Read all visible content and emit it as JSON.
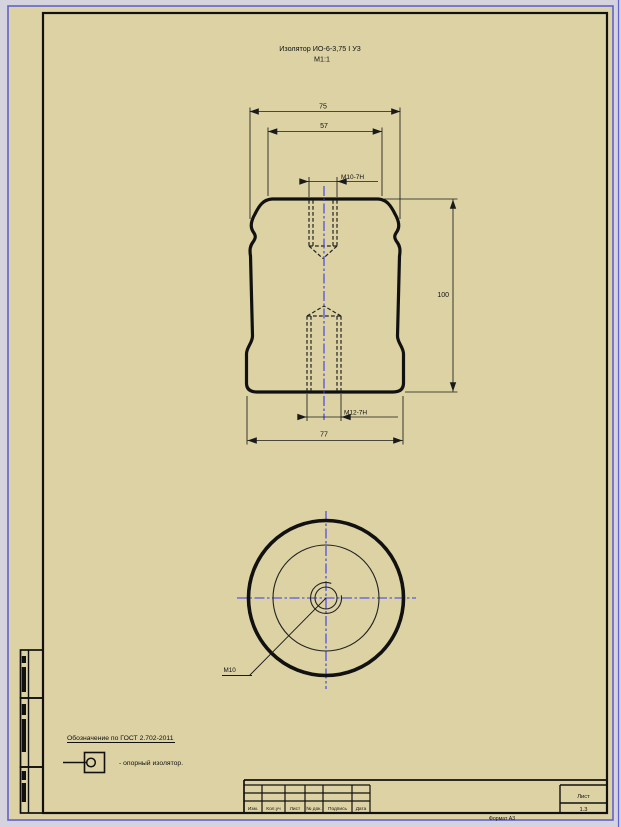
{
  "drawing": {
    "title": "Изолятор ИО-6-3,75 I У3",
    "scale": "М1:1",
    "front_view": {
      "dim_top_width": "75",
      "dim_face_width": "57",
      "dim_top_thread": "M10-7H",
      "dim_height": "100",
      "dim_bottom_thread": "M12-7H",
      "dim_bottom_width": "77"
    },
    "bottom_view": {
      "thread_callout": "M10"
    },
    "legend": {
      "heading": "Обозначение по ГОСТ 2.702-2011",
      "item_caption": "- опорный изолятор."
    },
    "title_block": {
      "columns": [
        "Изм.",
        "Кол.уч",
        "Лист",
        "№ док.",
        "Подпись",
        "Дата"
      ],
      "sheet_label": "Лист",
      "sheet_number": "1.3",
      "format_note": "Формат А3"
    },
    "colors": {
      "page_background": "#d5d3dd",
      "paper": "#dcd2a4",
      "paper_border": "#6161d1",
      "line": "#111111",
      "centerline": "#3a3af0"
    }
  }
}
